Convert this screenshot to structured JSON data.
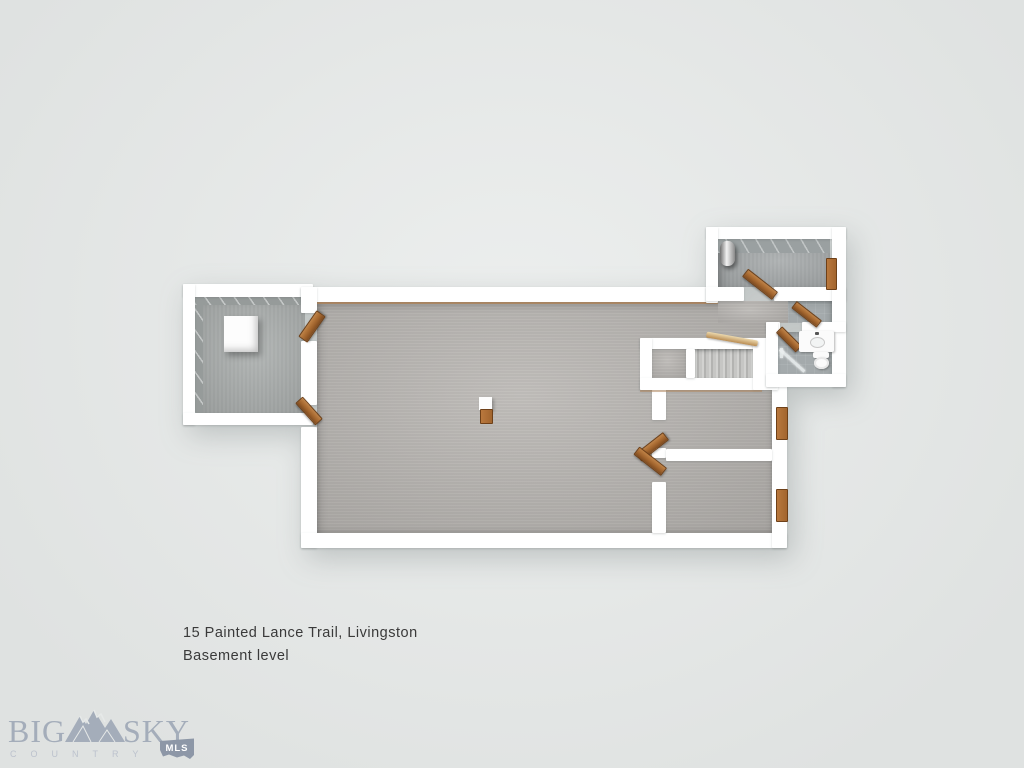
{
  "caption": {
    "line1": "15 Painted Lance Trail, Livingston",
    "line2": "Basement level"
  },
  "logo": {
    "word1": "BIG",
    "word2": "SKY",
    "subtitle": "COUNTRY",
    "badge": "MLS"
  },
  "colors": {
    "background": "#e6e9e8",
    "wall": "#ffffff",
    "carpet": "#b9b6b2",
    "concrete": "#a8acab",
    "tile": "#a4aaac",
    "door": "#a2652e",
    "caption_text": "#3a3a3a",
    "logo": "#a4adba",
    "logo_badge": "#8d97a7"
  }
}
